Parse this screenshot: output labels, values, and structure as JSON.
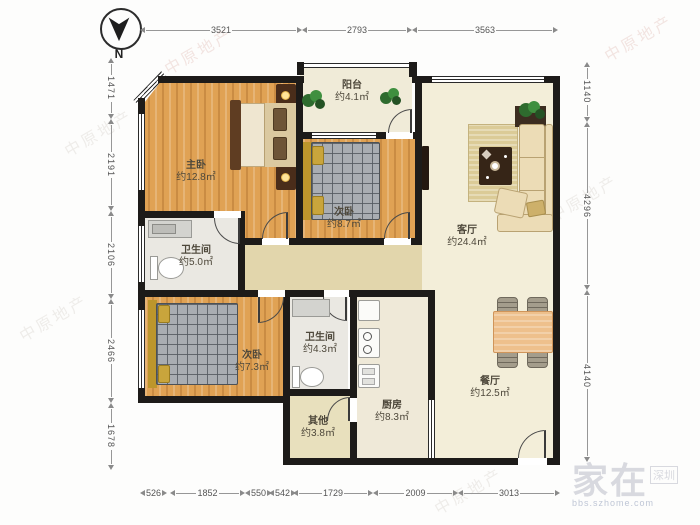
{
  "compass": {
    "label": "N"
  },
  "rooms": [
    {
      "name": "阳台",
      "area": "约4.1㎡"
    },
    {
      "name": "主卧",
      "area": "约12.8㎡"
    },
    {
      "name": "次卧",
      "area": "约8.7㎡"
    },
    {
      "name": "客厅",
      "area": "约24.4㎡"
    },
    {
      "name": "卫生间",
      "area": "约5.0㎡"
    },
    {
      "name": "次卧",
      "area": "约7.3㎡"
    },
    {
      "name": "卫生间",
      "area": "约4.3㎡"
    },
    {
      "name": "其他",
      "area": "约3.8㎡"
    },
    {
      "name": "厨房",
      "area": "约8.3㎡"
    },
    {
      "name": "餐厅",
      "area": "约12.5㎡"
    }
  ],
  "dimensions": {
    "top": [
      "3521",
      "2793",
      "3563"
    ],
    "left": [
      "1471",
      "2191",
      "2106",
      "2466",
      "1678"
    ],
    "right": [
      "1140",
      "4296",
      "4140"
    ],
    "bottom": [
      "526",
      "1852",
      "550",
      "542",
      "1729",
      "2009",
      "3013"
    ]
  },
  "watermark": {
    "brand": "中原地产",
    "logo_main": "家在",
    "logo_city": "深圳",
    "logo_url": "bbs.szhome.com"
  },
  "colors": {
    "wall": "#1d1b19",
    "wood_floor": "#e0a254",
    "living_floor": "#f3eed9",
    "hall_floor": "#e2d6ac",
    "bath_floor": "#eae8e2",
    "accent_gold": "#c9a53c"
  }
}
